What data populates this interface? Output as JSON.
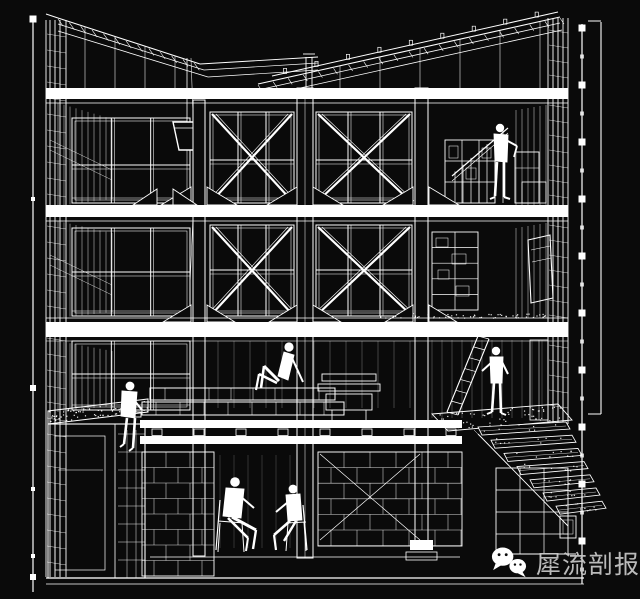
{
  "colors": {
    "background": "#0a0a0a",
    "line": "#ffffff",
    "watermark_text": "#c9c9c9"
  },
  "watermark": {
    "icon": "wechat-icon",
    "text": "犀流剖报"
  },
  "drawing": {
    "kind": "sectional-perspective-line-drawing"
  }
}
